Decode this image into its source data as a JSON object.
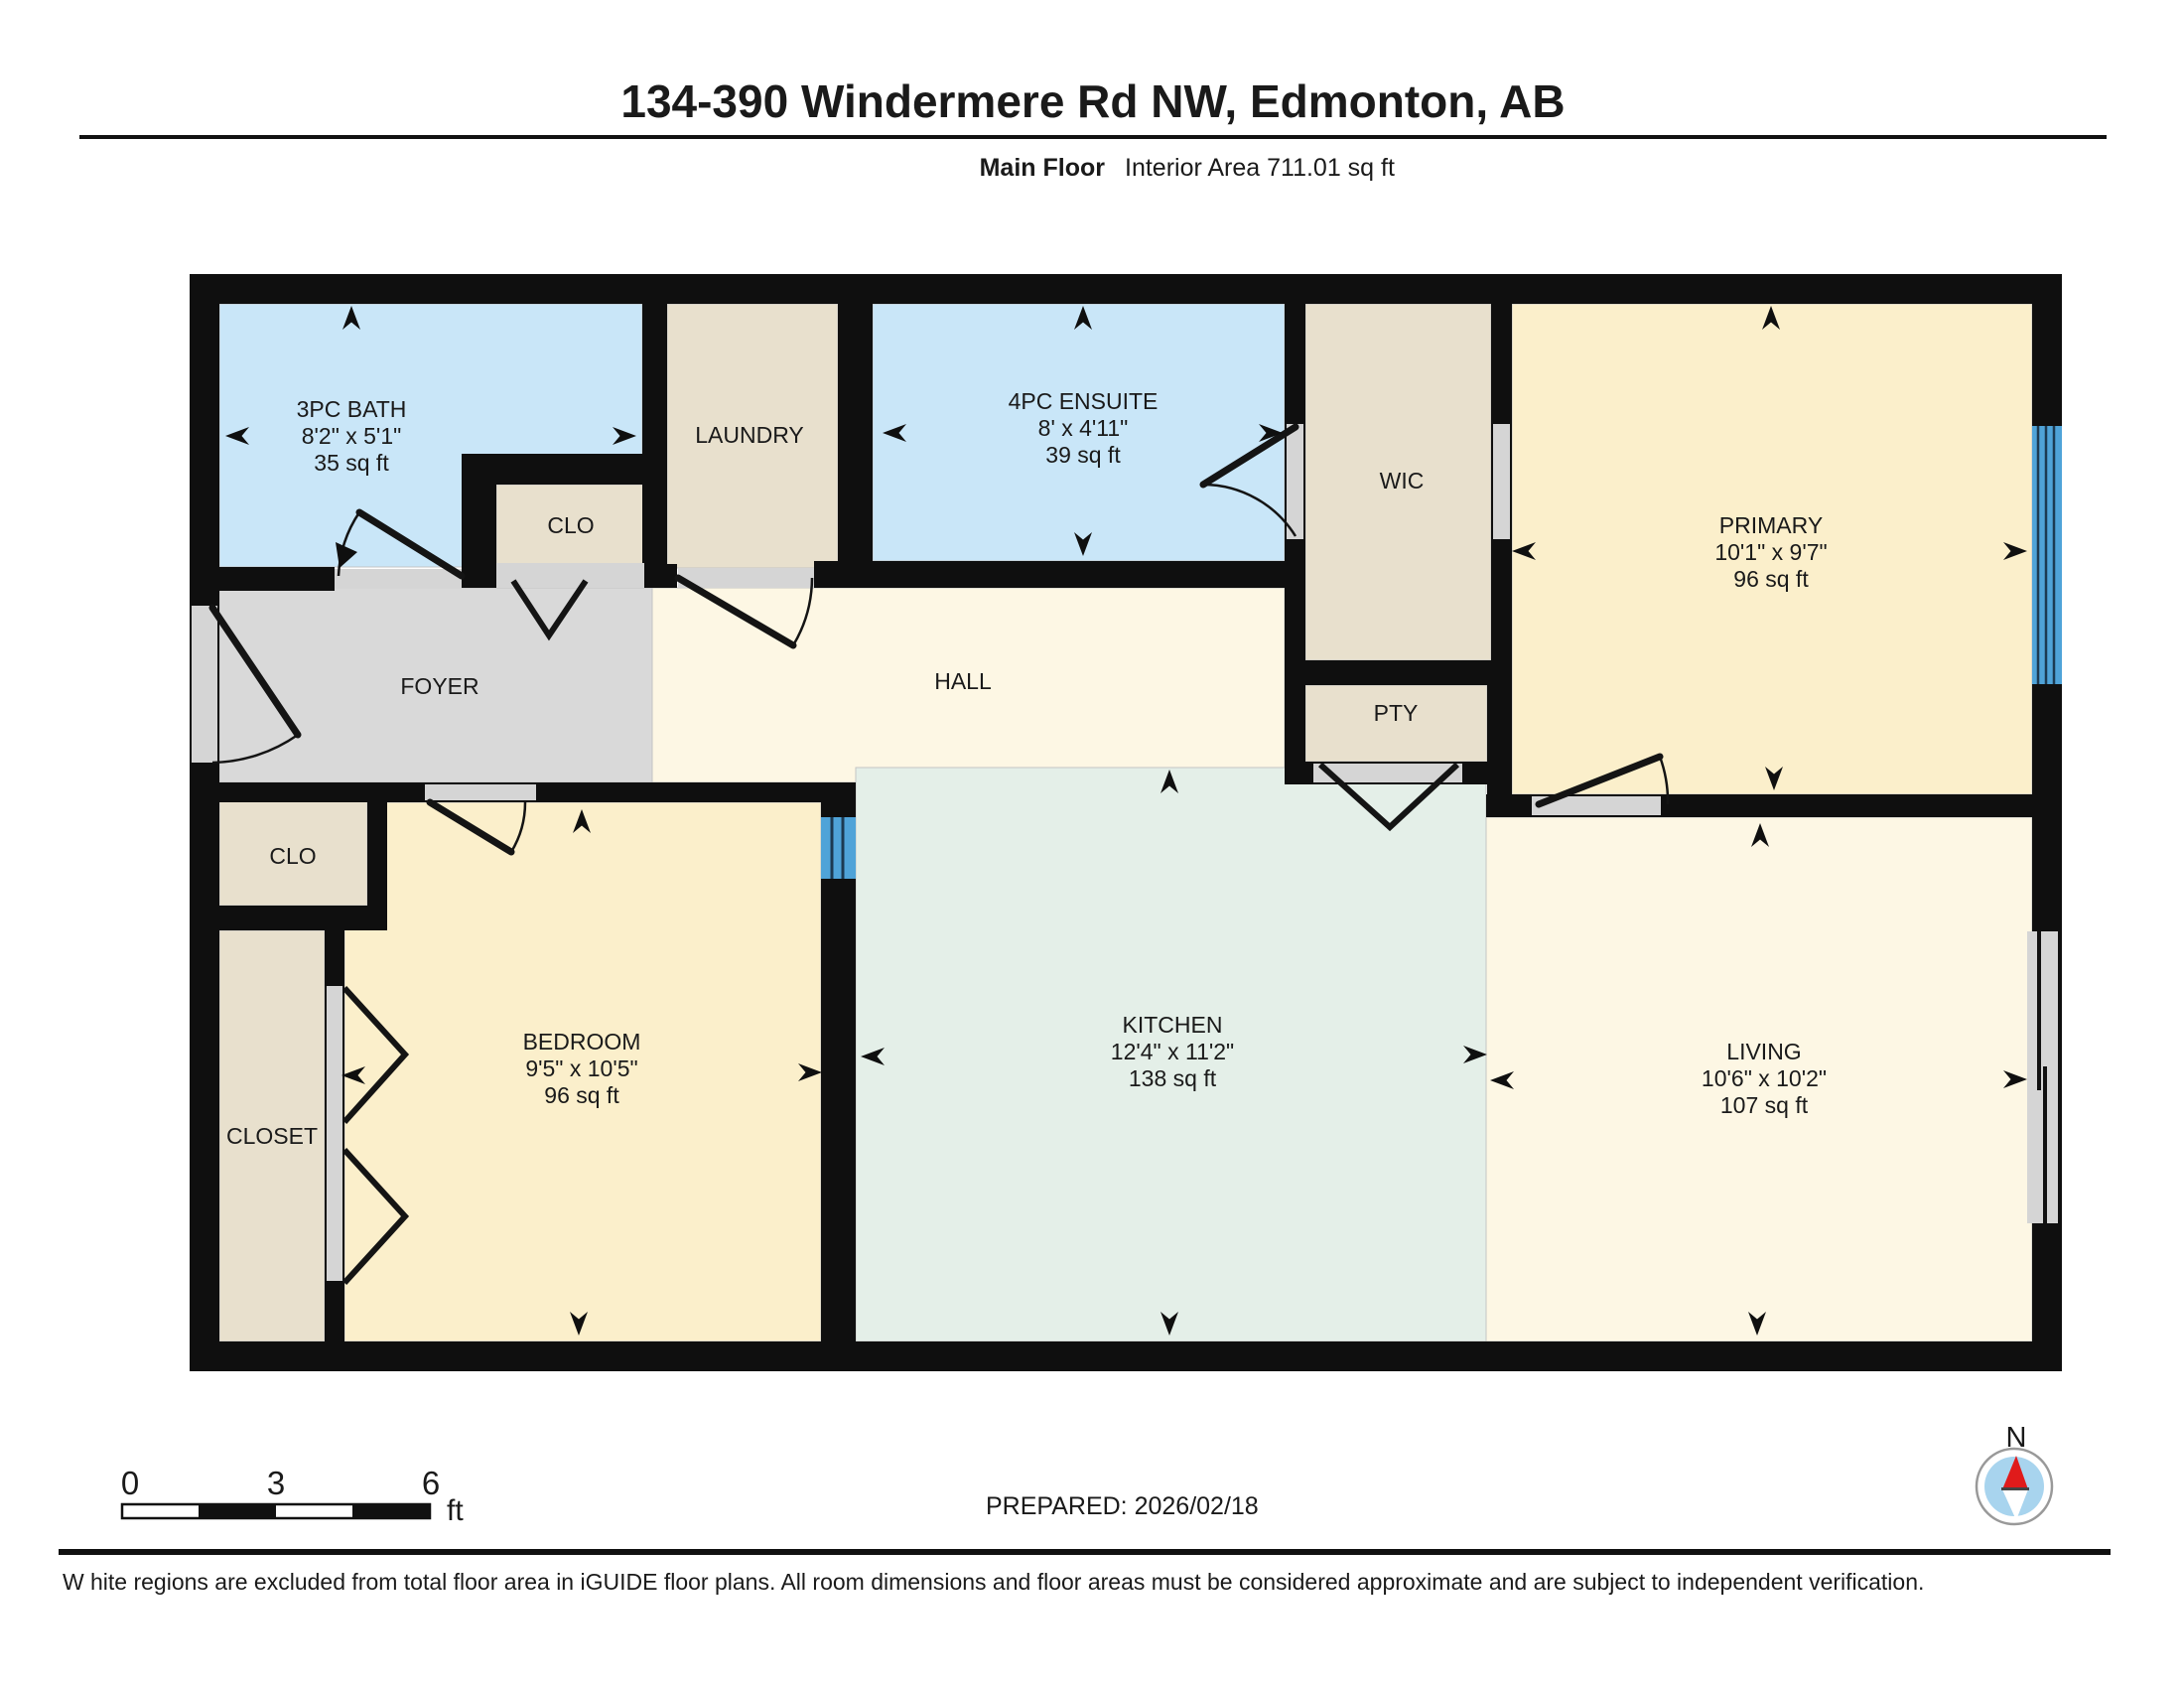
{
  "header": {
    "title": "134-390 Windermere Rd NW, Edmonton, AB",
    "floor_label": "Main Floor",
    "area_label": "Interior Area 711.01 sq ft"
  },
  "rooms": [
    {
      "id": "bath",
      "name": "3PC BATH",
      "dims": "8'2\" x 5'1\"",
      "area": "35 sq ft"
    },
    {
      "id": "laundry",
      "name": "LAUNDRY"
    },
    {
      "id": "clo-upper",
      "name": "CLO"
    },
    {
      "id": "ensuite",
      "name": "4PC ENSUITE",
      "dims": "8' x 4'11\"",
      "area": "39 sq ft"
    },
    {
      "id": "wic",
      "name": "WIC"
    },
    {
      "id": "primary",
      "name": "PRIMARY",
      "dims": "10'1\" x 9'7\"",
      "area": "96 sq ft"
    },
    {
      "id": "foyer",
      "name": "FOYER"
    },
    {
      "id": "hall",
      "name": "HALL"
    },
    {
      "id": "pty",
      "name": "PTY"
    },
    {
      "id": "clo-lower",
      "name": "CLO"
    },
    {
      "id": "closet",
      "name": "CLOSET"
    },
    {
      "id": "bedroom",
      "name": "BEDROOM",
      "dims": "9'5\" x 10'5\"",
      "area": "96 sq ft"
    },
    {
      "id": "kitchen",
      "name": "KITCHEN",
      "dims": "12'4\" x 11'2\"",
      "area": "138 sq ft"
    },
    {
      "id": "living",
      "name": "LIVING",
      "dims": "10'6\" x 10'2\"",
      "area": "107 sq ft"
    }
  ],
  "footer": {
    "prepared": "PREPARED: 2026/02/18",
    "scale": {
      "start": "0",
      "mid": "3",
      "end": "6",
      "unit": "ft"
    },
    "compass_label": "N",
    "disclaimer_first_letter": "W",
    "disclaimer_text": "hite regions are excluded from total floor area in iGUIDE floor plans. All room dimensions and floor areas must be considered approximate and are subject to independent verification."
  },
  "colors": {
    "wall": "#0f0f0f",
    "bath_blue": "#c9e6f8",
    "tan": "#e8e0cd",
    "yellow": "#fbefcb",
    "cream": "#fdf7e4",
    "kitchen_green": "#e4efe8",
    "foyer_gray": "#d9d9d9",
    "opening_gray": "#d5d5d5",
    "window_blue": "#4fa3d8",
    "compass_red": "#e01b1b",
    "compass_blue": "#a8d4ee"
  }
}
